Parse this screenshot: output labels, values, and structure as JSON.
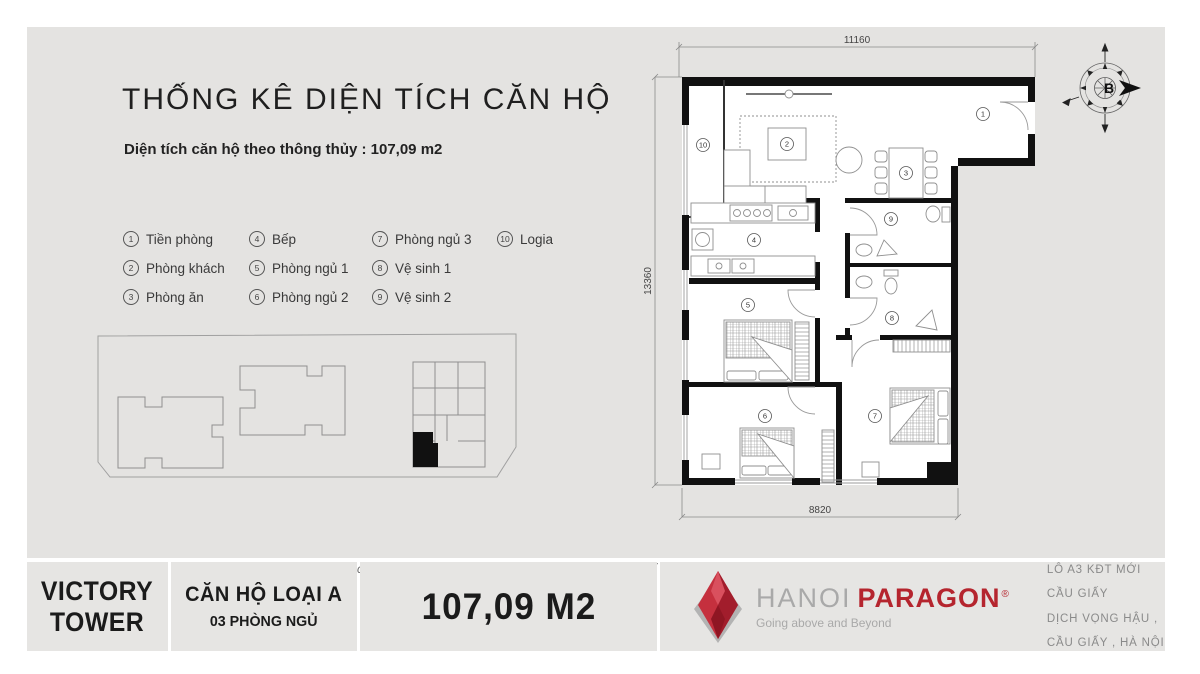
{
  "header": {
    "title": "THỐNG KÊ DIỆN TÍCH CĂN HỘ",
    "subtitle": "Diện tích căn hộ theo thông thủy : 107,09 m2"
  },
  "legend": {
    "items": [
      {
        "num": "1",
        "label": "Tiền phòng"
      },
      {
        "num": "2",
        "label": "Phòng khách"
      },
      {
        "num": "3",
        "label": "Phòng ăn"
      },
      {
        "num": "4",
        "label": "Bếp"
      },
      {
        "num": "5",
        "label": "Phòng ngủ 1"
      },
      {
        "num": "6",
        "label": "Phòng ngủ 2"
      },
      {
        "num": "7",
        "label": "Phòng ngủ 3"
      },
      {
        "num": "8",
        "label": "Vệ sinh 1"
      },
      {
        "num": "9",
        "label": "Vệ sinh 2"
      },
      {
        "num": "10",
        "label": "Logia"
      }
    ]
  },
  "floor_plan": {
    "dim_top": "11160",
    "dim_left": "13360",
    "dim_bottom": "8820",
    "compass_label": "B"
  },
  "disclaimer": "Bản vẽ nhằm mục đích mô tả mặt bằng và vị trí căn hộ. Các thông số có thể có những điều chỉnh nhỏ trong quá trình xây dựng .",
  "footer": {
    "building_line1": "VICTORY",
    "building_line2": "TOWER",
    "unit_type_line1": "CĂN HỘ LOẠI A",
    "unit_type_line2": "03 PHÒNG NGỦ",
    "area": "107,09 M2",
    "brand": {
      "name_gray": "HANOI",
      "name_red": "PARAGON",
      "reg": "®",
      "tagline": "Going above and Beyond"
    },
    "address_line1": "LÔ A3 KĐT MỚI CẦU GIẤY",
    "address_line2": "DỊCH VỌNG HẬU , CẦU GIẤY , HÀ NỘI"
  },
  "colors": {
    "brand_red": "#b5252e",
    "canvas_gray": "#e4e3e1",
    "wall_black": "#111111"
  }
}
